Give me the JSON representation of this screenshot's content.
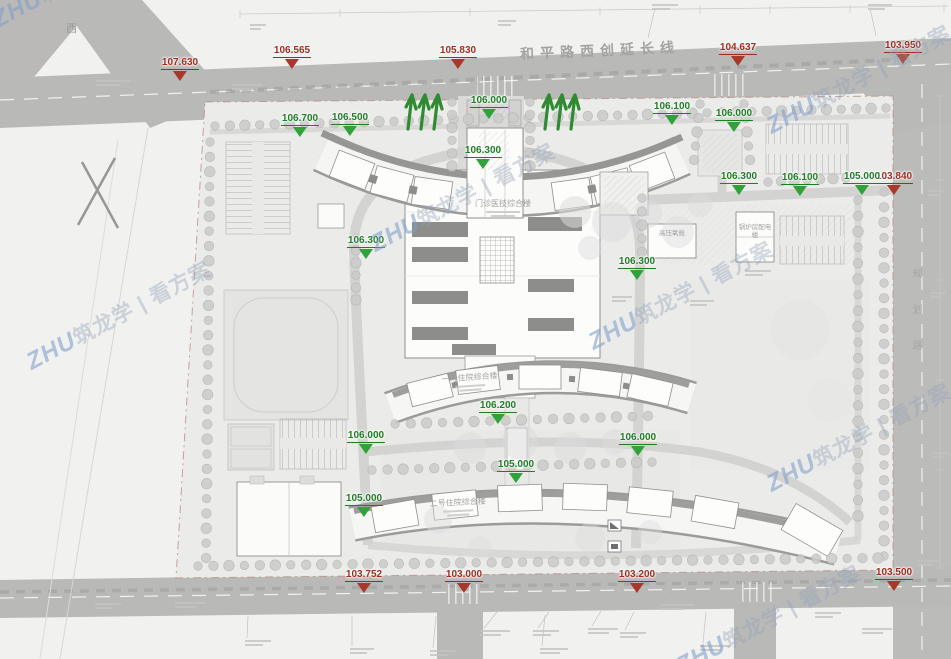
{
  "plan": {
    "road_top_label": "和平路西创延长线",
    "road_right_label": "规划路",
    "corner_label_west": "西",
    "buildings": {
      "outpatient": "门诊医技综合楼",
      "inpatient1": "一号住院综合楼",
      "inpatient2": "二号住院综合楼",
      "hyperbaric": "高压氧舱",
      "boiler": "锅炉房配电楼"
    }
  },
  "markers": {
    "red_color": "#a8392a",
    "green_color": "#2fa339",
    "red": [
      {
        "value": "107.630",
        "x": 180,
        "y": 52
      },
      {
        "value": "106.565",
        "x": 292,
        "y": 40
      },
      {
        "value": "105.830",
        "x": 458,
        "y": 40
      },
      {
        "value": "104.637",
        "x": 738,
        "y": 37
      },
      {
        "value": "103.950",
        "x": 903,
        "y": 35
      },
      {
        "value": "103.840",
        "x": 894,
        "y": 166
      },
      {
        "value": "103.752",
        "x": 364,
        "y": 564
      },
      {
        "value": "103.000",
        "x": 464,
        "y": 564
      },
      {
        "value": "103.200",
        "x": 637,
        "y": 564
      },
      {
        "value": "103.500",
        "x": 894,
        "y": 562
      }
    ],
    "green": [
      {
        "value": "106.000",
        "x": 489,
        "y": 90
      },
      {
        "value": "106.100",
        "x": 672,
        "y": 96
      },
      {
        "value": "106.000",
        "x": 734,
        "y": 103
      },
      {
        "value": "106.700",
        "x": 300,
        "y": 108
      },
      {
        "value": "106.500",
        "x": 350,
        "y": 107
      },
      {
        "value": "106.300",
        "x": 483,
        "y": 140
      },
      {
        "value": "106.300",
        "x": 739,
        "y": 166
      },
      {
        "value": "106.100",
        "x": 800,
        "y": 167
      },
      {
        "value": "105.000",
        "x": 862,
        "y": 166
      },
      {
        "value": "106.300",
        "x": 366,
        "y": 230
      },
      {
        "value": "106.300",
        "x": 637,
        "y": 251
      },
      {
        "value": "106.200",
        "x": 498,
        "y": 395
      },
      {
        "value": "106.000",
        "x": 638,
        "y": 427
      },
      {
        "value": "106.000",
        "x": 366,
        "y": 425
      },
      {
        "value": "105.000",
        "x": 516,
        "y": 454
      },
      {
        "value": "105.000",
        "x": 364,
        "y": 488
      }
    ]
  },
  "watermark": {
    "brand": "ZHU",
    "text": "筑龙学 | 看方案",
    "instances": [
      {
        "x": -6,
        "y": 6
      },
      {
        "x": 28,
        "y": 348
      },
      {
        "x": 372,
        "y": 230
      },
      {
        "x": 590,
        "y": 328
      },
      {
        "x": 768,
        "y": 112
      },
      {
        "x": 768,
        "y": 470
      },
      {
        "x": 678,
        "y": 652
      }
    ]
  },
  "decor": {
    "tree_fill": "#cbcbca",
    "tree_rows": [
      [
        215,
        126,
        886,
        108,
        46
      ],
      [
        210,
        142,
        206,
        558,
        29
      ],
      [
        884,
        192,
        884,
        556,
        25
      ],
      [
        198,
        566,
        878,
        558,
        45
      ],
      [
        395,
        424,
        648,
        416,
        17
      ],
      [
        372,
        470,
        652,
        462,
        19
      ],
      [
        452,
        102,
        452,
        166,
        6
      ],
      [
        530,
        102,
        530,
        166,
        6
      ],
      [
        700,
        104,
        694,
        160,
        5
      ],
      [
        744,
        104,
        750,
        160,
        5
      ],
      [
        356,
        238,
        356,
        300,
        6
      ],
      [
        642,
        198,
        642,
        252,
        5
      ],
      [
        858,
        200,
        858,
        516,
        21
      ],
      [
        768,
        182,
        846,
        178,
        7
      ]
    ],
    "canopies": [
      [
        575,
        212,
        16,
        0.55
      ],
      [
        612,
        222,
        20,
        0.5
      ],
      [
        648,
        214,
        14,
        0.5
      ],
      [
        678,
        232,
        16,
        0.45
      ],
      [
        700,
        205,
        12,
        0.45
      ],
      [
        590,
        248,
        12,
        0.45
      ],
      [
        470,
        448,
        16,
        0.5
      ],
      [
        520,
        442,
        18,
        0.5
      ],
      [
        570,
        448,
        16,
        0.5
      ],
      [
        615,
        442,
        13,
        0.45
      ],
      [
        438,
        520,
        14,
        0.45
      ],
      [
        480,
        548,
        12,
        0.4
      ],
      [
        590,
        538,
        15,
        0.4
      ],
      [
        650,
        532,
        12,
        0.4
      ],
      [
        800,
        330,
        30,
        0.2
      ],
      [
        830,
        400,
        22,
        0.18
      ]
    ],
    "note_stubs": [
      [
        652,
        4,
        26
      ],
      [
        868,
        4,
        24
      ],
      [
        498,
        20,
        18
      ],
      [
        250,
        24,
        16
      ],
      [
        96,
        80,
        34
      ],
      [
        232,
        84,
        30
      ],
      [
        928,
        190,
        16
      ],
      [
        930,
        292,
        16
      ],
      [
        932,
        452,
        16
      ],
      [
        918,
        560,
        20
      ],
      [
        480,
        630,
        30
      ],
      [
        533,
        630,
        26
      ],
      [
        588,
        628,
        30
      ],
      [
        620,
        632,
        26
      ],
      [
        660,
        604,
        34
      ],
      [
        700,
        645,
        30
      ],
      [
        540,
        648,
        28
      ],
      [
        430,
        650,
        26
      ],
      [
        175,
        602,
        30
      ],
      [
        95,
        603,
        26
      ],
      [
        245,
        640,
        26
      ],
      [
        350,
        648,
        24
      ],
      [
        815,
        612,
        26
      ],
      [
        862,
        628,
        30
      ],
      [
        745,
        270,
        26
      ],
      [
        690,
        300,
        24
      ],
      [
        612,
        296,
        20
      ]
    ],
    "tree_symbols": [
      {
        "x": 408,
        "y": 95
      },
      {
        "x": 545,
        "y": 95
      }
    ]
  }
}
